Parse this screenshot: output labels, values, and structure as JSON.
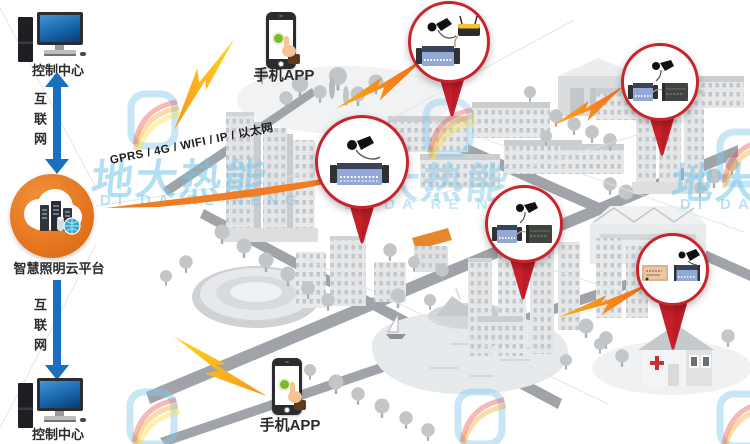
{
  "watermark": {
    "cn": "地大热能",
    "en": "DI DA RE NENG"
  },
  "left_panel": {
    "control_center_top": "控制中心",
    "internet_top": "互联网",
    "cloud_platform": "智慧照明云平台",
    "internet_bottom": "互联网",
    "control_center_bottom": "控制中心"
  },
  "mobile": {
    "top": "手机APP",
    "bottom": "手机APP"
  },
  "banner": {
    "label": "GPRS / 4G / WIFI / IP / 以太网"
  },
  "callouts": [
    {
      "name": "zone-1",
      "devices": [
        "gsm-antenna",
        "lighting-controller",
        "wireless-router"
      ]
    },
    {
      "name": "zone-2",
      "devices": [
        "gsm-antenna",
        "lighting-controller",
        "power-module"
      ]
    },
    {
      "name": "zone-3",
      "devices": [
        "gsm-antenna",
        "lighting-controller"
      ]
    },
    {
      "name": "zone-4",
      "devices": [
        "gsm-antenna",
        "lighting-controller",
        "power-module"
      ]
    },
    {
      "name": "zone-5",
      "devices": [
        "power-module",
        "lighting-controller",
        "gsm-antenna"
      ]
    }
  ],
  "colors": {
    "accent_orange": "#EE7B23",
    "pin_red": "#C7202A",
    "arrow_blue": "#1B6FBF",
    "watermark_blue": "#7CC4E6",
    "bolt_yellow": "#FFD21E"
  }
}
